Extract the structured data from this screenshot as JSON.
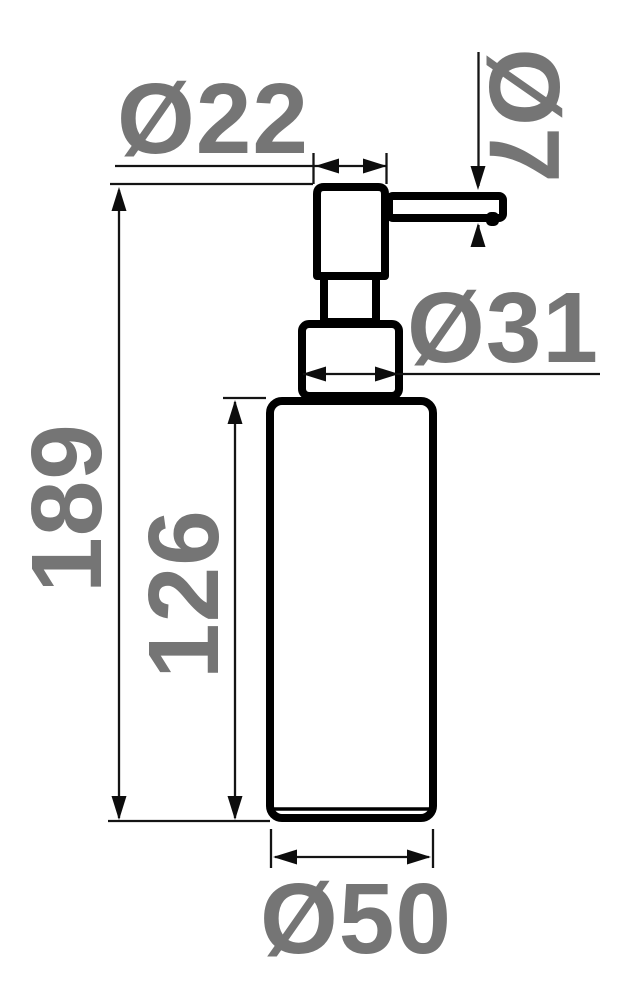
{
  "drawing": {
    "subject": "soap-dispenser-pump-bottle",
    "colors": {
      "background": "#ffffff",
      "outline": "#000000",
      "dimension_lines": "#141414",
      "labels": "#757575"
    },
    "dimensions": {
      "pump_head_diameter": "Ø22",
      "spout_diameter": "Ø7",
      "collar_diameter": "Ø31",
      "overall_height": "189",
      "body_height": "126",
      "body_diameter": "Ø50"
    }
  }
}
